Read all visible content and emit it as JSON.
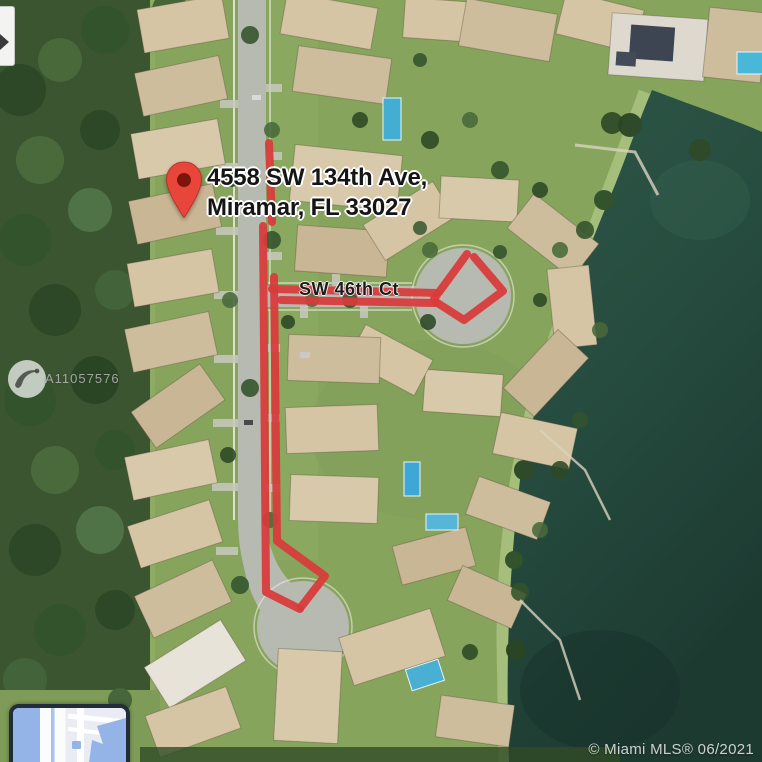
{
  "map": {
    "street_label": "SW 46th Ct",
    "view": "satellite"
  },
  "marker": {
    "address_line1": "4558 SW 134th Ave,",
    "address_line2": "Miramar, FL 33027"
  },
  "watermark": {
    "listing_id": "A11057576"
  },
  "footer": {
    "copyright": "© Miami MLS® 06/2021"
  },
  "annotation": {
    "color": "#d93a3a",
    "stroke_width": 8,
    "paths": [
      [
        [
          269,
          143
        ],
        [
          272,
          222
        ]
      ],
      [
        [
          263,
          226
        ],
        [
          266,
          592
        ],
        [
          300,
          609
        ]
      ],
      [
        [
          274,
          277
        ],
        [
          277,
          541
        ],
        [
          325,
          576
        ],
        [
          301,
          607
        ]
      ],
      [
        [
          272,
          289
        ],
        [
          437,
          293
        ]
      ],
      [
        [
          281,
          300
        ],
        [
          435,
          303
        ]
      ],
      [
        [
          434,
          299
        ],
        [
          467,
          254
        ]
      ],
      [
        [
          474,
          257
        ],
        [
          503,
          291
        ],
        [
          464,
          320
        ],
        [
          436,
          302
        ]
      ]
    ]
  },
  "icons": {
    "map_pin": "teardrop-map-pin",
    "mls_logo": "bird-in-white-circle",
    "inset_map": "mini-map-thumbnail",
    "cropped_control": "left-edge-triangle-control"
  },
  "colors": {
    "annotation_red": "#d93a3a",
    "pin_red": "#e8463b",
    "pin_dot": "#7e150d",
    "water_dark": "#24463a",
    "road_gray": "#b6bab0",
    "roof_tan": "#d5c5a5",
    "inset_water": "#94b3e6",
    "inset_border": "#232c39",
    "label_halo": "#ffffff"
  }
}
